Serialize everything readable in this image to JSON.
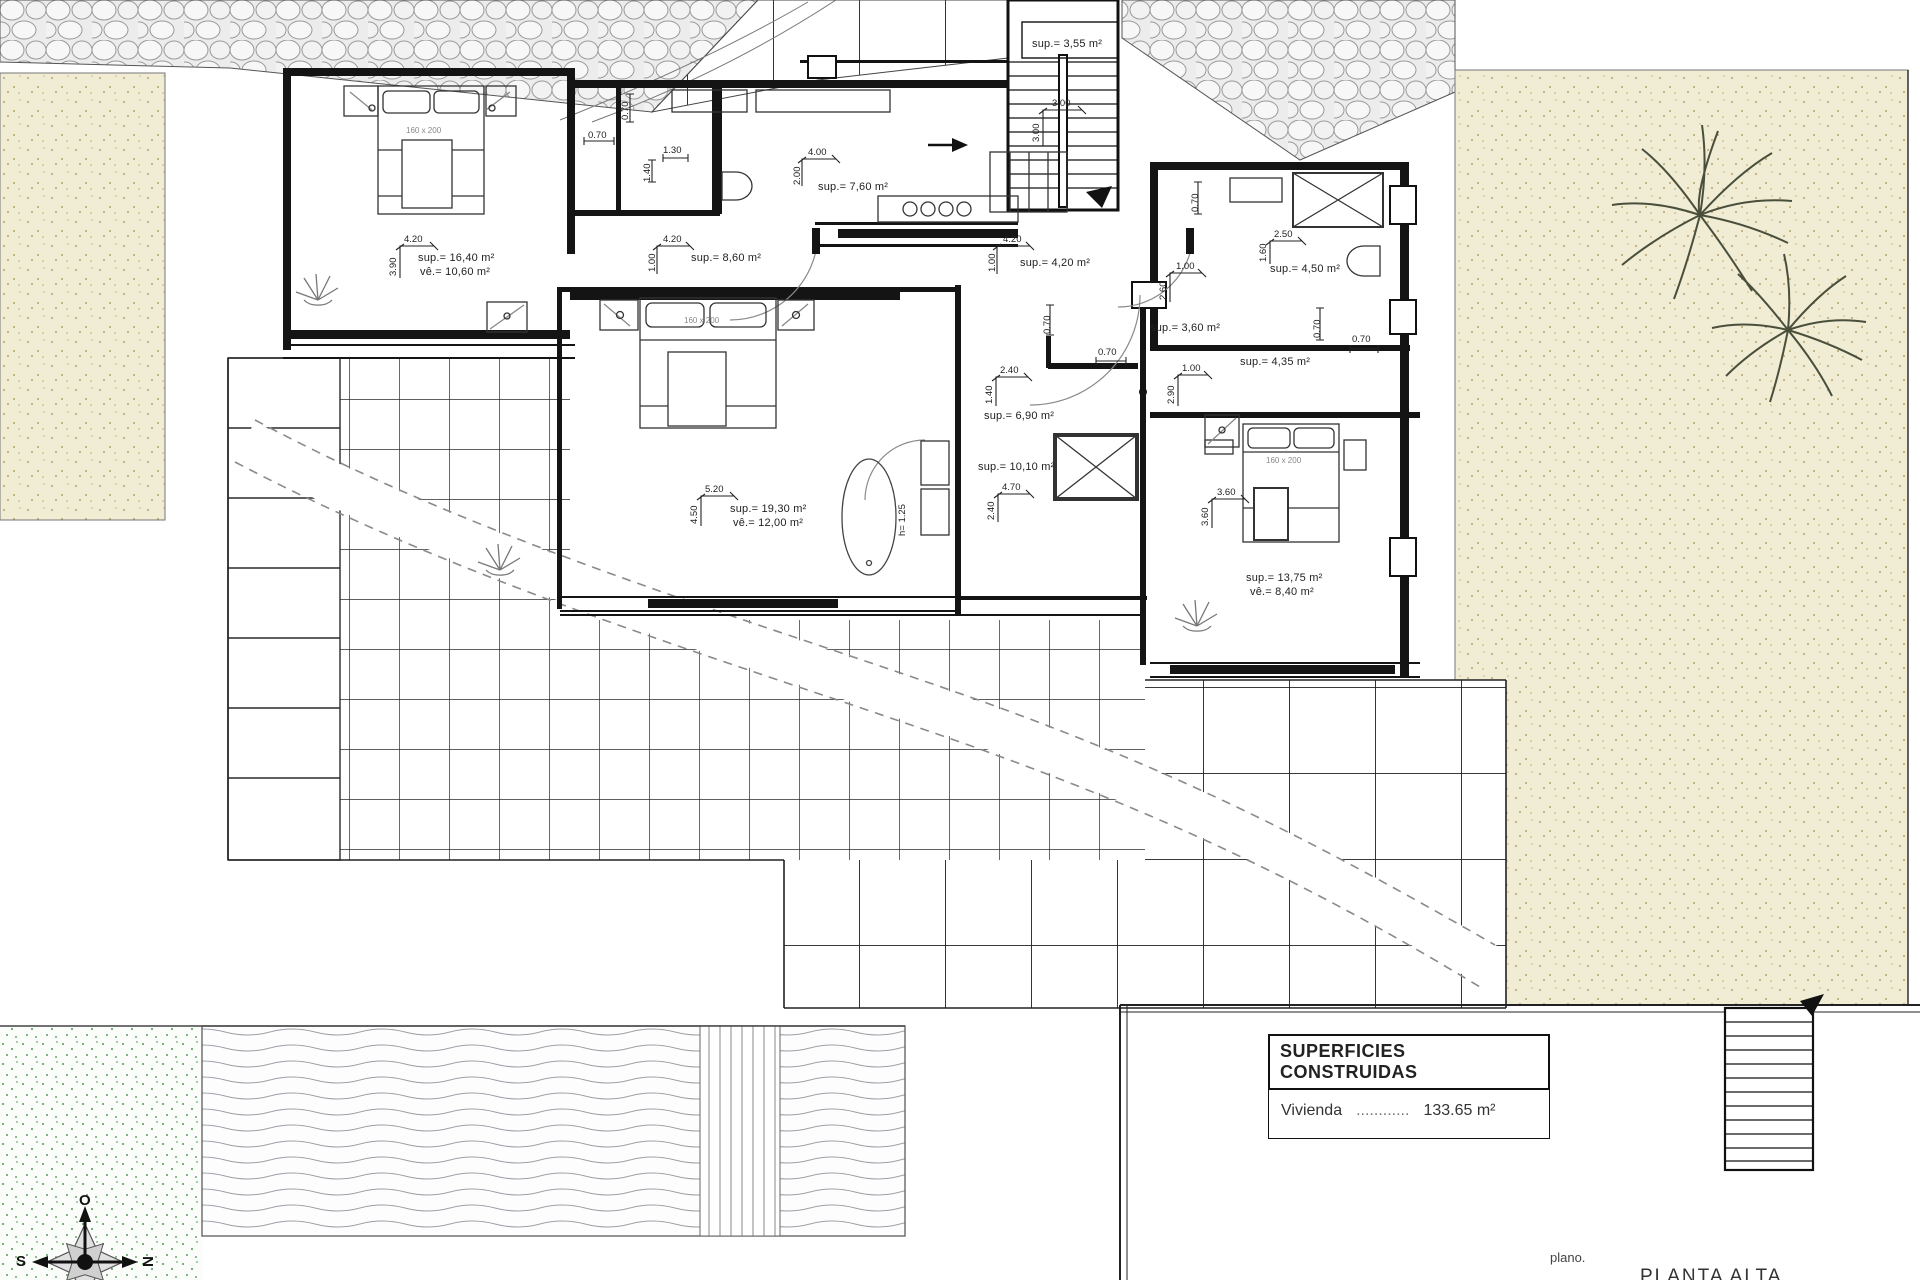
{
  "title_block": {
    "field_label": "plano.",
    "plan_name": "PLANTA  ALTA"
  },
  "areas_table": {
    "header": "SUPERFICIES CONSTRUIDAS",
    "rows": [
      {
        "label": "Vivienda",
        "dots": "............",
        "value": "133.65 m²"
      }
    ]
  },
  "compass": {
    "top": "O",
    "left": "S",
    "right": "N"
  },
  "beds": {
    "size_label": "160 x 200"
  },
  "misc": {
    "tub_height": "h= 1.25"
  },
  "dims": {
    "d070": "0.70",
    "d130": "1.30",
    "d140": "1.40"
  },
  "rooms": [
    {
      "id": "bedroom-1",
      "sup": "sup.= 16,40 m²",
      "util": "vê.= 10,60 m²",
      "dim_w": "4.20",
      "dim_h": "3.90"
    },
    {
      "id": "hall",
      "sup": "sup.= 8,60 m²",
      "dim_w": "4.20",
      "dim_h": "1.00"
    },
    {
      "id": "kitchen",
      "sup": "sup.= 7,60 m²",
      "dim_w": "4.00",
      "dim_h": "2.00"
    },
    {
      "id": "corridor",
      "sup": "sup.= 4,20 m²",
      "dim_w": "4.20",
      "dim_h": "1.00"
    },
    {
      "id": "stairs",
      "sup": "sup.= 3,55 m²",
      "dim_w": "3.00",
      "dim_h": "3.00"
    },
    {
      "id": "bath-small",
      "sup": "sup.= 3,60 m²",
      "dim_w": "1.00",
      "dim_h": "2.60"
    },
    {
      "id": "bath-top-right",
      "sup": "sup.= 4,50 m²",
      "dim_w": "2.50",
      "dim_h": "1.60"
    },
    {
      "id": "dressing",
      "sup": "sup.= 4,35 m²",
      "dim_w": "1.00",
      "dim_h": "2.90"
    },
    {
      "id": "bath-center",
      "sup": "sup.= 6,90 m²",
      "dim_w": "2.40",
      "dim_h": "1.40"
    },
    {
      "id": "utility",
      "sup": "sup.= 10,10 m²",
      "dim_w": "4.70",
      "dim_h": "2.40"
    },
    {
      "id": "bedroom-2",
      "sup": "sup.= 19,30 m²",
      "util": "vê.= 12,00 m²",
      "dim_w": "5.20",
      "dim_h": "4.50"
    },
    {
      "id": "bedroom-3",
      "sup": "sup.= 13,75 m²",
      "util": "vê.= 8,40 m²",
      "dim_w": "3.60",
      "dim_h": "3.60"
    }
  ],
  "colors": {
    "wall": "#141414",
    "tile_line": "#2a2a2a",
    "sand": "#f1ecd4",
    "pool_green": "#6cab6c",
    "stone": "#e9e9e9"
  }
}
